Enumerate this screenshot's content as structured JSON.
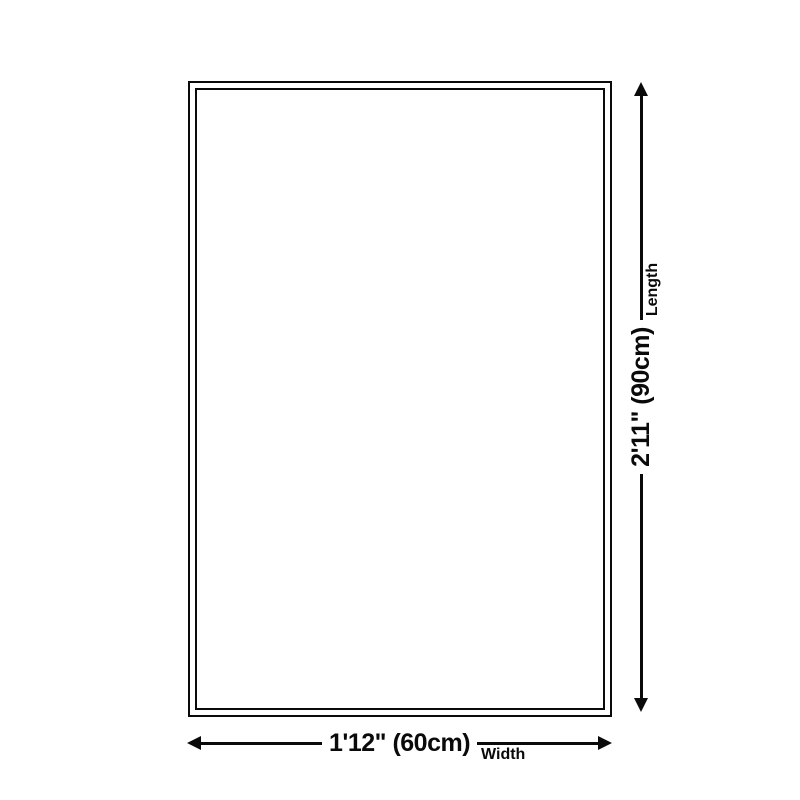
{
  "diagram": {
    "type": "product-dimension-diagram",
    "colors": {
      "background": "#ffffff",
      "line": "#0a0a0a"
    },
    "width_annotation": {
      "dimension": "1'12\" (60cm)",
      "axis_label": "Width"
    },
    "length_annotation": {
      "dimension": "2'11\" (90cm)",
      "axis_label": "Length"
    }
  }
}
